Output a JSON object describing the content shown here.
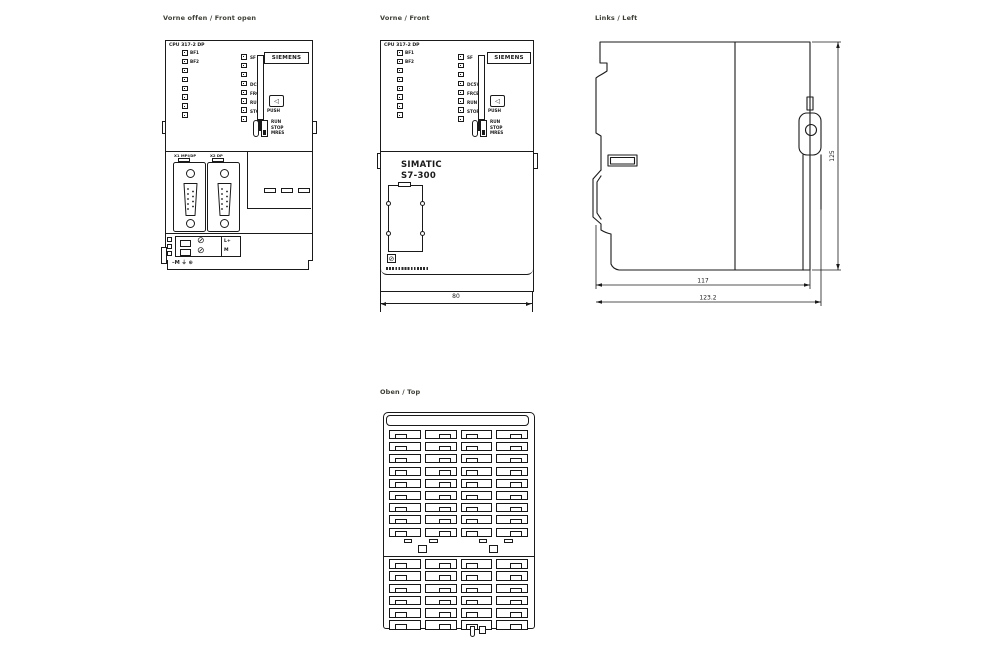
{
  "page": {
    "background": "#ffffff",
    "line_color": "#1a1a1a",
    "label_color": "#3c3c35"
  },
  "views": {
    "front_open": {
      "label": "Vorne offen / Front open"
    },
    "front": {
      "label": "Vorne / Front"
    },
    "left": {
      "label": "Links / Left"
    },
    "top": {
      "label": "Oben / Top"
    }
  },
  "panel": {
    "cpu_label": "CPU 317-2 DP",
    "left_led_labels": [
      "BF1",
      "BF2"
    ],
    "right_led_labels": [
      "SF",
      "DC5V",
      "FRCE",
      "RUN",
      "STOP"
    ],
    "brand_plate": "SIEMENS",
    "eject_icon": "◁",
    "push_label": "PUSH",
    "mode_positions": [
      "RUN",
      "STOP",
      "MRES"
    ]
  },
  "front_open_view": {
    "port1_label": "X1 MPI/DP",
    "port2_label": "X2 DP",
    "terminal_labels": [
      "L+",
      "M"
    ],
    "screw_icon": "⊘",
    "ground_marking": "–M ⏚ ⊕"
  },
  "front_view": {
    "product_line1": "SIMATIC",
    "product_line2": "S7-300"
  },
  "dimensions": {
    "width_mm": "80",
    "depth_rail_mm": "117",
    "depth_total_mm": "123.2",
    "height_mm": "125"
  },
  "led_counts": {
    "left": "8",
    "right": "8"
  },
  "top_view": {
    "upper_grid": "9x4",
    "lower_grid": "6x4"
  }
}
